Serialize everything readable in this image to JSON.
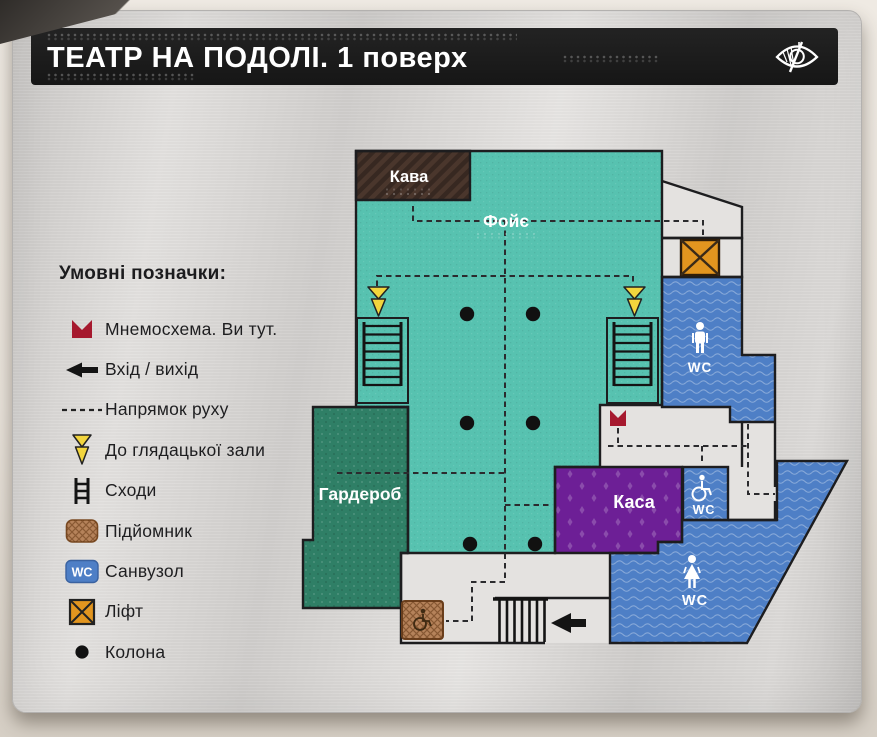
{
  "header": {
    "title": "ТЕАТР НА ПОДОЛІ. 1 поверх"
  },
  "legend": {
    "title": "Умовні позначки:",
    "wc_badge_text": "WC",
    "items": [
      {
        "icon": "you-are-here-marker-icon",
        "label": "Мнемосхема. Ви тут."
      },
      {
        "icon": "entrance-exit-arrow-icon",
        "label": "Вхід / вихід"
      },
      {
        "icon": "direction-dashes-icon",
        "label": "Напрямок руху"
      },
      {
        "icon": "to-auditorium-bolt-icon",
        "label": "До глядацької зали"
      },
      {
        "icon": "stairs-icon",
        "label": "Сходи"
      },
      {
        "icon": "platform-lift-icon",
        "label": "Підйомник"
      },
      {
        "icon": "wc-icon",
        "label": "Санвузол"
      },
      {
        "icon": "elevator-icon",
        "label": "Ліфт"
      },
      {
        "icon": "column-icon",
        "label": "Колона"
      }
    ]
  },
  "floorplan": {
    "rooms": {
      "cafe": {
        "label": "Кава",
        "color": "#4a362c"
      },
      "foyer": {
        "label": "Фойє",
        "color": "#57c2b0"
      },
      "cloakroom": {
        "label": "Гардероб",
        "color": "#2f7f66"
      },
      "ticket_office": {
        "label": "Каса",
        "color": "#6d1f96"
      },
      "wc_men": {
        "label": "WC"
      },
      "wc_accessible": {
        "label": "WC"
      },
      "wc_women": {
        "label": "WC"
      }
    },
    "colors": {
      "wc_blue": "#4e7fc6",
      "elevator_orange": "#e2951f",
      "lift_tan": "#b5825a",
      "wall": "#1d1d1f",
      "marker_red": "#a6192e",
      "bolt_yellow": "#f2d53d",
      "room_white": "#e4e2e0"
    }
  }
}
